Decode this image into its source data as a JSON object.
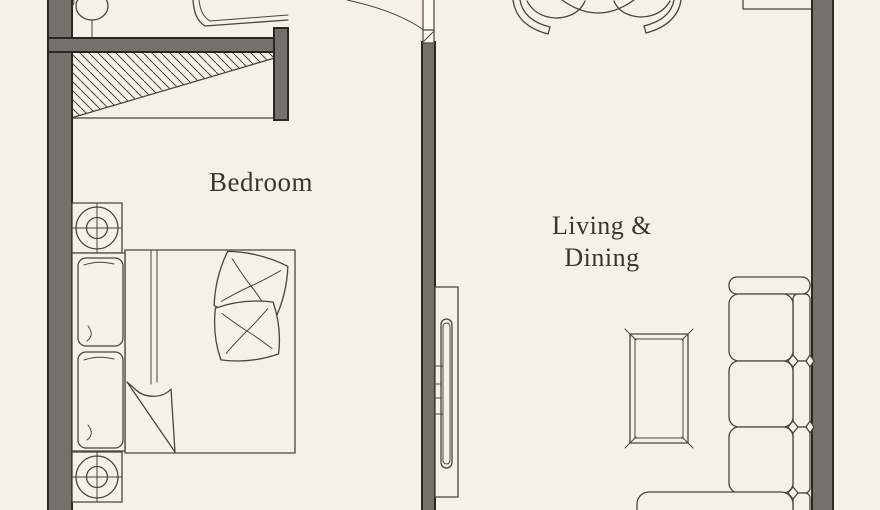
{
  "page": {
    "type": "apartment-floor-plan",
    "background": "#f7f0e8"
  },
  "colors": {
    "background": "#f7f0e8",
    "wall_fill": "#757069",
    "wall_outline": "#2b2723",
    "line": "#4a443c",
    "text": "#3a352d"
  },
  "rooms": {
    "bedroom": {
      "label": "Bedroom"
    },
    "living_dining": {
      "label": "Living &\nDining"
    }
  },
  "furniture_icons": [
    "toilet-icon",
    "vanity-icon",
    "wardrobe-hatch-icon",
    "ceiling-speaker-icon",
    "door-swing-icon",
    "double-bed-icon",
    "throw-pillow-icon",
    "tv-console-icon",
    "coffee-table-icon",
    "sofa-sectional-icon",
    "dining-table-icon",
    "dining-chair-icon",
    "kitchen-counter-icon"
  ]
}
